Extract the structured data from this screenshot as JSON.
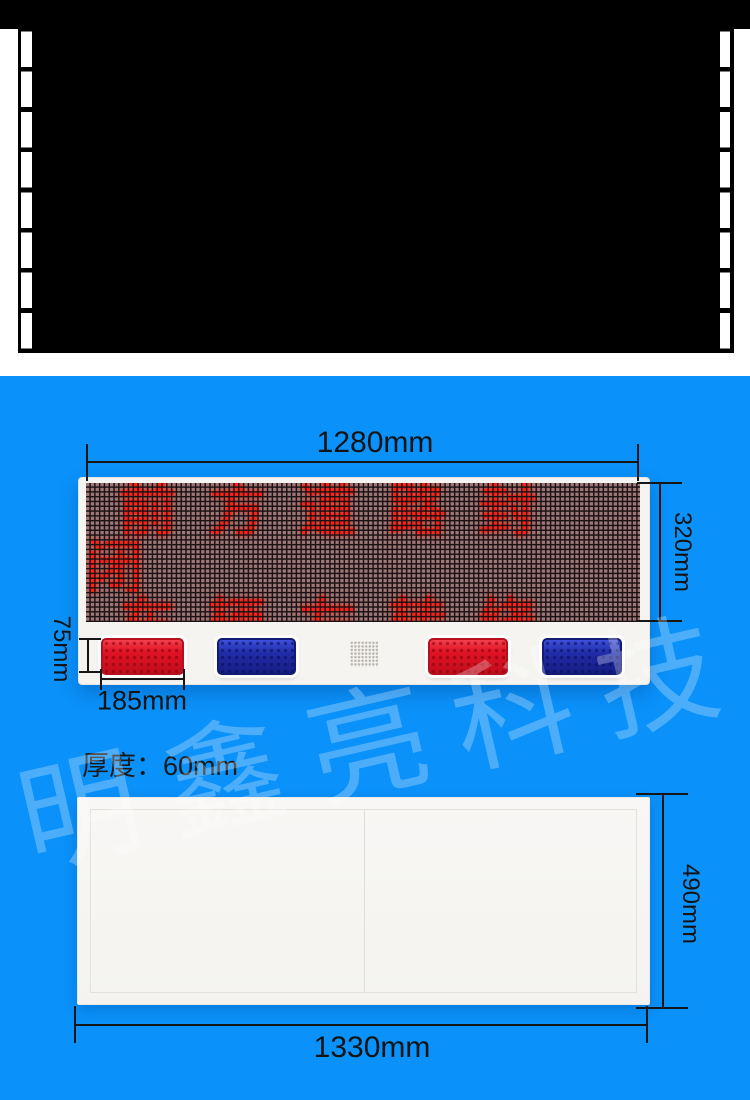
{
  "colors": {
    "page_background": "#0a91fa",
    "film_strip": "#000000",
    "led_lit": "#ff2015",
    "reflector_red": "#e01425",
    "reflector_blue": "#202ca8",
    "dimension_ink": "#161616",
    "watermark": "rgba(255,255,255,0.27)"
  },
  "sign_front": {
    "width_label": "1280mm",
    "height_label": "320mm",
    "reflector_height_label": "75mm",
    "reflector_width_label": "185mm",
    "led_line1": "前方道路封闭",
    "led_line2": "车辆左转绕行"
  },
  "thickness_label": "厚度：60mm",
  "sign_back": {
    "height_label": "490mm",
    "width_label": "1330mm"
  },
  "watermark_text": "明鑫亮科技"
}
